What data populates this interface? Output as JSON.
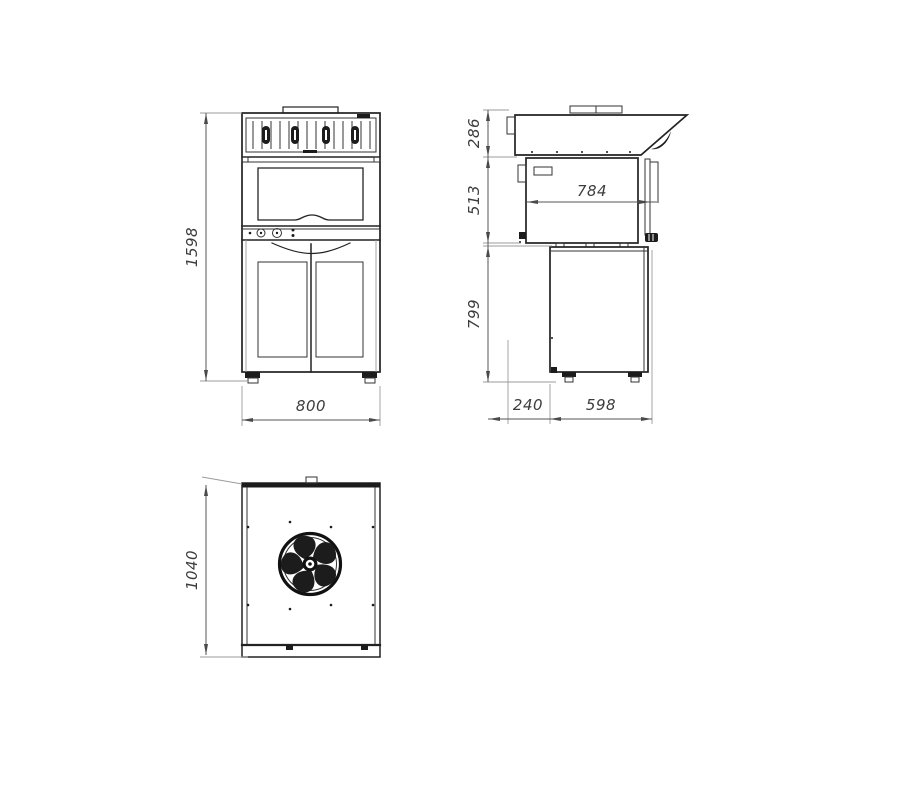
{
  "dimensions": {
    "front_height": "1598",
    "front_width": "800",
    "hood_height": "286",
    "oven_section_height": "513",
    "oven_inner_depth": "784",
    "base_height": "799",
    "front_overhang": "240",
    "base_depth": "598",
    "top_view_depth": "1040"
  },
  "fan": {
    "blade_count": 5
  },
  "colors": {
    "object_line": "#222222",
    "dimension_line": "#565656",
    "extension_line": "#9b9b9b",
    "dimension_text": "#3c3c3c",
    "background": "#ffffff"
  }
}
